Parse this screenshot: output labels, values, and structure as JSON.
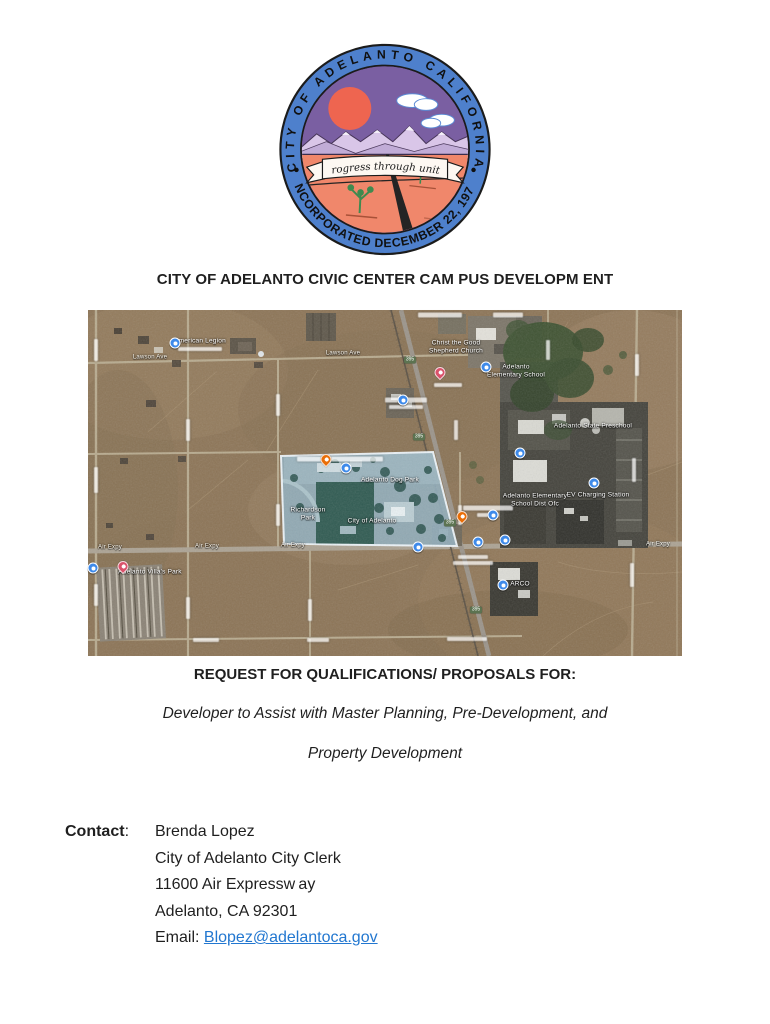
{
  "page": {
    "title": "CITY OF ADELANTO CIVIC CENTER CAM PUS DEVELOPM ENT",
    "request_heading": "REQUEST FOR QUALIFICATIONS/ PROPOSALS FOR:",
    "subtitle_line1": "Developer to Assist with Master Planning, Pre-Development, and",
    "subtitle_line2": "Property Development"
  },
  "seal": {
    "ring_text_top": "CITY OF ADELANTO CALIFORNIA",
    "ring_text_bottom": "INCORPORATED DECEMBER 22, 1970",
    "motto": "“Progress through unity”",
    "colors": {
      "ring_blue": "#4e80cc",
      "sky_purple": "#7a5fa2",
      "sun_orange": "#ee6550",
      "ground_salmon": "#f0876b",
      "mountain_lavender": "#d9c6e8",
      "tree_green": "#3f8a4f"
    }
  },
  "map": {
    "colors": {
      "desert": "#8e7555",
      "parcel_fill": "#8fadbc",
      "parcel_outline": "#eef6fb",
      "road": "#b9ab8e"
    },
    "labels": [
      {
        "t": "American Legion",
        "x": 112,
        "y": 31,
        "cls": "place"
      },
      {
        "t": "Lawson Ave",
        "x": 62,
        "y": 48,
        "cls": "road"
      },
      {
        "t": "Lawson Ave",
        "x": 255,
        "y": 44,
        "cls": "road"
      },
      {
        "t": "Christ the Good",
        "x": 368,
        "y": 33,
        "cls": "place"
      },
      {
        "t": "Shepherd Church",
        "x": 368,
        "y": 41,
        "cls": "place"
      },
      {
        "t": "Adelanto",
        "x": 428,
        "y": 57,
        "cls": "place"
      },
      {
        "t": "Elementary School",
        "x": 428,
        "y": 65,
        "cls": "place"
      },
      {
        "t": "Adelanto State Preschool",
        "x": 505,
        "y": 116,
        "cls": "place"
      },
      {
        "t": "Adelanto Elementary",
        "x": 447,
        "y": 186,
        "cls": "place"
      },
      {
        "t": "School Dist Ofc",
        "x": 447,
        "y": 194,
        "cls": "place"
      },
      {
        "t": "EV Charging Station",
        "x": 510,
        "y": 185,
        "cls": "place"
      },
      {
        "t": "Adelanto Dog Park",
        "x": 302,
        "y": 170,
        "cls": "place"
      },
      {
        "t": "Richardson",
        "x": 220,
        "y": 200,
        "cls": "place"
      },
      {
        "t": "Park",
        "x": 220,
        "y": 208,
        "cls": "place"
      },
      {
        "t": "City of Adelanto",
        "x": 284,
        "y": 211,
        "cls": "place"
      },
      {
        "t": "Adelanto Villa's Park",
        "x": 62,
        "y": 262,
        "cls": "place"
      },
      {
        "t": "Air Expy",
        "x": 22,
        "y": 238,
        "cls": "road"
      },
      {
        "t": "Air Expy",
        "x": 119,
        "y": 237,
        "cls": "road"
      },
      {
        "t": "Air Expy",
        "x": 205,
        "y": 236,
        "cls": "road"
      },
      {
        "t": "Air Expy",
        "x": 570,
        "y": 235,
        "cls": "road"
      },
      {
        "t": "ARCO",
        "x": 432,
        "y": 274,
        "cls": "place"
      }
    ],
    "shields": [
      {
        "x": 322,
        "y": 50,
        "text": "395"
      },
      {
        "x": 331,
        "y": 127,
        "text": "395"
      },
      {
        "x": 362,
        "y": 213,
        "text": "395"
      },
      {
        "x": 388,
        "y": 300,
        "text": "395"
      }
    ],
    "pins": [
      {
        "type": "blue",
        "x": 87,
        "y": 33
      },
      {
        "type": "blue",
        "x": 398,
        "y": 57
      },
      {
        "type": "pink",
        "x": 352,
        "y": 68
      },
      {
        "type": "blue",
        "x": 315,
        "y": 90
      },
      {
        "type": "blue",
        "x": 432,
        "y": 143
      },
      {
        "type": "blue",
        "x": 506,
        "y": 173
      },
      {
        "type": "orange",
        "x": 238,
        "y": 155
      },
      {
        "type": "blue",
        "x": 258,
        "y": 158
      },
      {
        "type": "orange",
        "x": 374,
        "y": 212
      },
      {
        "type": "blue",
        "x": 405,
        "y": 205
      },
      {
        "type": "blue",
        "x": 390,
        "y": 232
      },
      {
        "type": "blue",
        "x": 417,
        "y": 230
      },
      {
        "type": "blue",
        "x": 330,
        "y": 237
      },
      {
        "type": "pink",
        "x": 35,
        "y": 262
      },
      {
        "type": "blue",
        "x": 5,
        "y": 258
      },
      {
        "type": "blue",
        "x": 415,
        "y": 275
      }
    ],
    "smudges": [
      {
        "x": 252,
        "y": 149,
        "w": 86,
        "h": 5
      },
      {
        "x": 112,
        "y": 39,
        "w": 44,
        "h": 4
      },
      {
        "x": 352,
        "y": 5,
        "w": 44,
        "h": 5
      },
      {
        "x": 420,
        "y": 5,
        "w": 30,
        "h": 5
      },
      {
        "x": 318,
        "y": 90,
        "w": 42,
        "h": 5
      },
      {
        "x": 318,
        "y": 97,
        "w": 34,
        "h": 4
      },
      {
        "x": 360,
        "y": 75,
        "w": 28,
        "h": 4
      },
      {
        "x": 400,
        "y": 198,
        "w": 50,
        "h": 5
      },
      {
        "x": 400,
        "y": 205,
        "w": 22,
        "h": 4
      },
      {
        "x": 385,
        "y": 247,
        "w": 30,
        "h": 4
      },
      {
        "x": 385,
        "y": 253,
        "w": 40,
        "h": 4
      },
      {
        "x": 379,
        "y": 329,
        "w": 40,
        "h": 4
      },
      {
        "x": 118,
        "y": 330,
        "w": 26,
        "h": 4
      },
      {
        "x": 230,
        "y": 330,
        "w": 22,
        "h": 4
      },
      {
        "x": 8,
        "y": 40,
        "w": 22,
        "h": 4,
        "rot": 90
      },
      {
        "x": 8,
        "y": 170,
        "w": 26,
        "h": 4,
        "rot": 90
      },
      {
        "x": 8,
        "y": 285,
        "w": 22,
        "h": 4,
        "rot": 90
      },
      {
        "x": 100,
        "y": 120,
        "w": 22,
        "h": 4,
        "rot": 90
      },
      {
        "x": 100,
        "y": 298,
        "w": 22,
        "h": 4,
        "rot": 90
      },
      {
        "x": 190,
        "y": 95,
        "w": 22,
        "h": 4,
        "rot": 90
      },
      {
        "x": 190,
        "y": 205,
        "w": 22,
        "h": 4,
        "rot": 90
      },
      {
        "x": 222,
        "y": 300,
        "w": 22,
        "h": 4,
        "rot": 90
      },
      {
        "x": 372,
        "y": 205,
        "w": 20,
        "h": 4,
        "rot": 90
      },
      {
        "x": 549,
        "y": 55,
        "w": 22,
        "h": 4,
        "rot": 90
      },
      {
        "x": 546,
        "y": 160,
        "w": 24,
        "h": 4,
        "rot": 90
      },
      {
        "x": 544,
        "y": 265,
        "w": 24,
        "h": 4,
        "rot": 90
      },
      {
        "x": 460,
        "y": 40,
        "w": 20,
        "h": 4,
        "rot": 90
      },
      {
        "x": 368,
        "y": 120,
        "w": 20,
        "h": 4,
        "rot": 90
      }
    ]
  },
  "contact": {
    "label": "Contact",
    "label_suffix": ":",
    "lines": [
      "Brenda Lopez",
      "City of Adelanto City Clerk",
      "11600 Air Expressw ay",
      "Adelanto, CA 92301"
    ],
    "email_label": "Email:",
    "email_link": "Blopez@adelantoca.gov"
  }
}
